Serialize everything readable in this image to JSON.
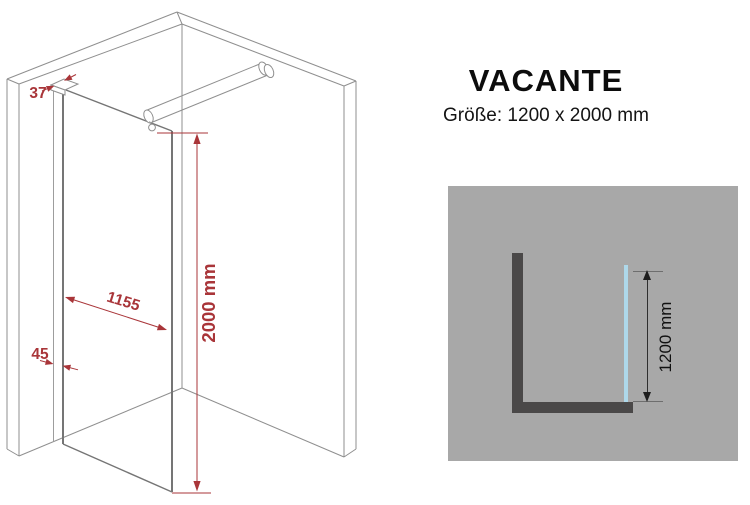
{
  "product": {
    "title": "VACANTE",
    "size_label": "Größe: 1200 x 2000 mm"
  },
  "iso_drawing": {
    "description": "isometric line drawing of walk-in glass shower panel in a wall corner with stabilizer bar",
    "dims": {
      "wall_gap": "37",
      "glass_width": "1155",
      "profile_width": "45",
      "height": "2000 mm"
    }
  },
  "top_view": {
    "description": "top-down schematic of L-shaped wall corner with glass panel",
    "dims": {
      "width": "1200 mm"
    }
  },
  "colors": {
    "dimension_red": "#a93539",
    "drawing_line_gray": "#8f8f8f",
    "glass_edge_gray": "#757575",
    "panel_background_gray": "#a8a8a8",
    "wall_dark_gray": "#4a4848",
    "glass_blue": "#aed8ea",
    "text_black": "#0c0c0c"
  }
}
